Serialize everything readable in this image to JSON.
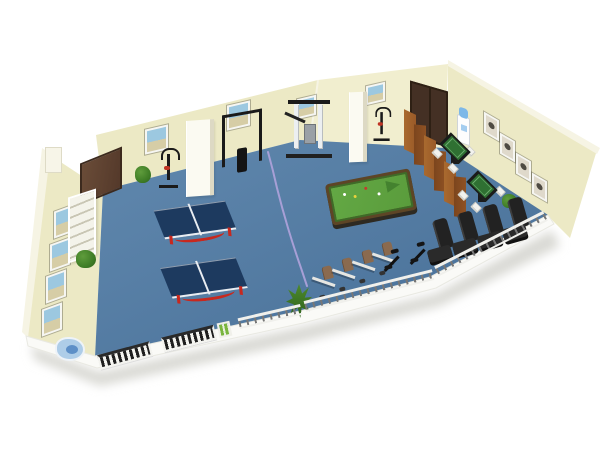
{
  "scene": {
    "title": "3D isometric cutaway render of a fitness and recreation activity room",
    "room_type": "gym / multi-activity room",
    "view": "isometric cutaway, white background"
  },
  "objects": {
    "ping_pong_tables": 2,
    "pool_tables": 1,
    "mahjong_tables": 2,
    "mahjong_chairs": 7,
    "massage_chairs": 4,
    "recumbent_exercise_bikes": 4,
    "spin_bikes": 2,
    "upright_exercise_bikes": 2,
    "pull_up_rack": 1,
    "multi_station_gym_machine": 1,
    "folding_screen_panels": 6,
    "doors": 2,
    "pillars": 2,
    "wall_pictures_back_wall": 4,
    "wall_pictures_right_wall": 4,
    "wall_pictures_left_wall": 4,
    "plants": 4,
    "radiators": 2,
    "railing_segments": 3,
    "water_dispenser": 1,
    "drinking_fountain": 1,
    "shelf_unit": 1,
    "power_box": 1,
    "floor_cable": 1
  },
  "colors": {
    "floor": "#4e7aa4",
    "wall": "#ece9c5",
    "wall_light": "#f1eecf",
    "wall_rim": "#f6f4e4",
    "door_brown": "#54392a",
    "door_dark": "#443024",
    "screen_wood_light": "#9a5a28",
    "screen_wood_dark": "#7c451d",
    "pingpong_top": "#1d3a5f",
    "pingpong_leg": "#c8281e",
    "net_white": "#e9edf2",
    "pool_body": "#5d4526",
    "pool_felt": "#5a9c3c",
    "pool_felt_dark": "#3e6b28",
    "mahjong_green": "#2f7032",
    "mahjong_black": "#1b1b1b",
    "chair_white": "#f2f2ee",
    "equip_black": "#1a1a1a",
    "equip_grey": "#9aa0a6",
    "machine_white": "#eceff1",
    "seat_brown": "#8a6a4f",
    "massage_chair": "#222222",
    "massage_chair_hi": "#3d3d3d",
    "railing_white": "#f0f0ec",
    "railing_post": "#777777",
    "radiator_slat": "#1f1f1f",
    "radiator_frame": "#f3f3ef",
    "power_box_green": "#79b53e",
    "plant_green": "#3f7d26",
    "plant_dark": "#2d611a",
    "fountain_blue": "#aecde8",
    "fountain_water": "#5d8fc7",
    "dispenser_bottle": "#7db8e8",
    "cable_purple": "#a79fd6",
    "pillar_white": "#fbfaf2",
    "pic_frame": "#f6f6f2",
    "photo_sky": "#9cc8e0",
    "photo_sand": "#d6cda6",
    "sketch_bg": "#dfd9cb",
    "sketch_ink": "#4e4a42",
    "shelf_white": "#f4f3ea",
    "shelf_line": "#c9c6b4",
    "shadow": "#d9d9d4"
  }
}
